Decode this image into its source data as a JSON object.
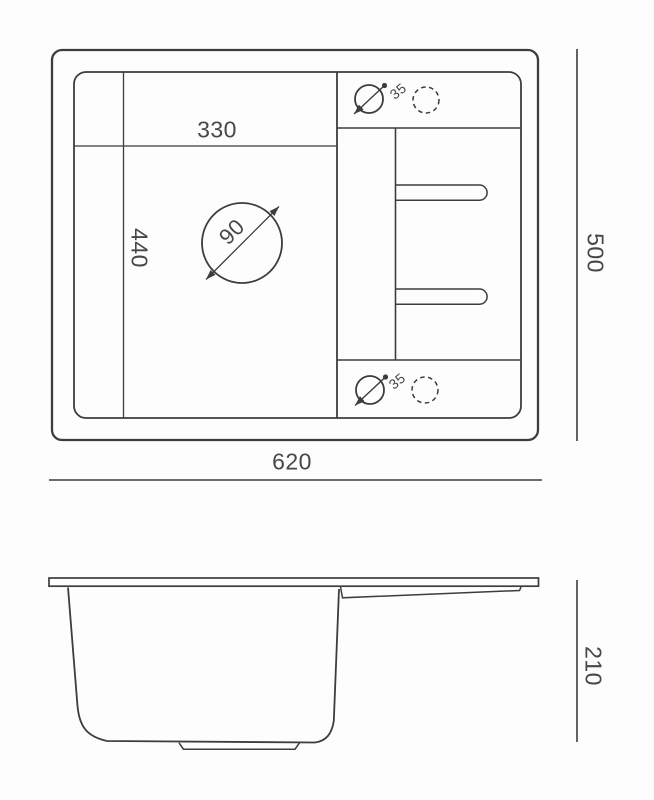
{
  "drawing": {
    "kind": "sink technical drawing",
    "views": [
      "top view",
      "side view"
    ]
  },
  "labels": {
    "bowl_width": "330",
    "bowl_depth": "440",
    "drain_diameter": "90",
    "tap_hole_top": "35",
    "tap_hole_bottom": "35",
    "overall_width": "620",
    "overall_depth": "500",
    "overall_height": "210"
  },
  "colors": {
    "line": "#3d3d3d",
    "text": "#474747",
    "background": "#fdfdfd"
  }
}
